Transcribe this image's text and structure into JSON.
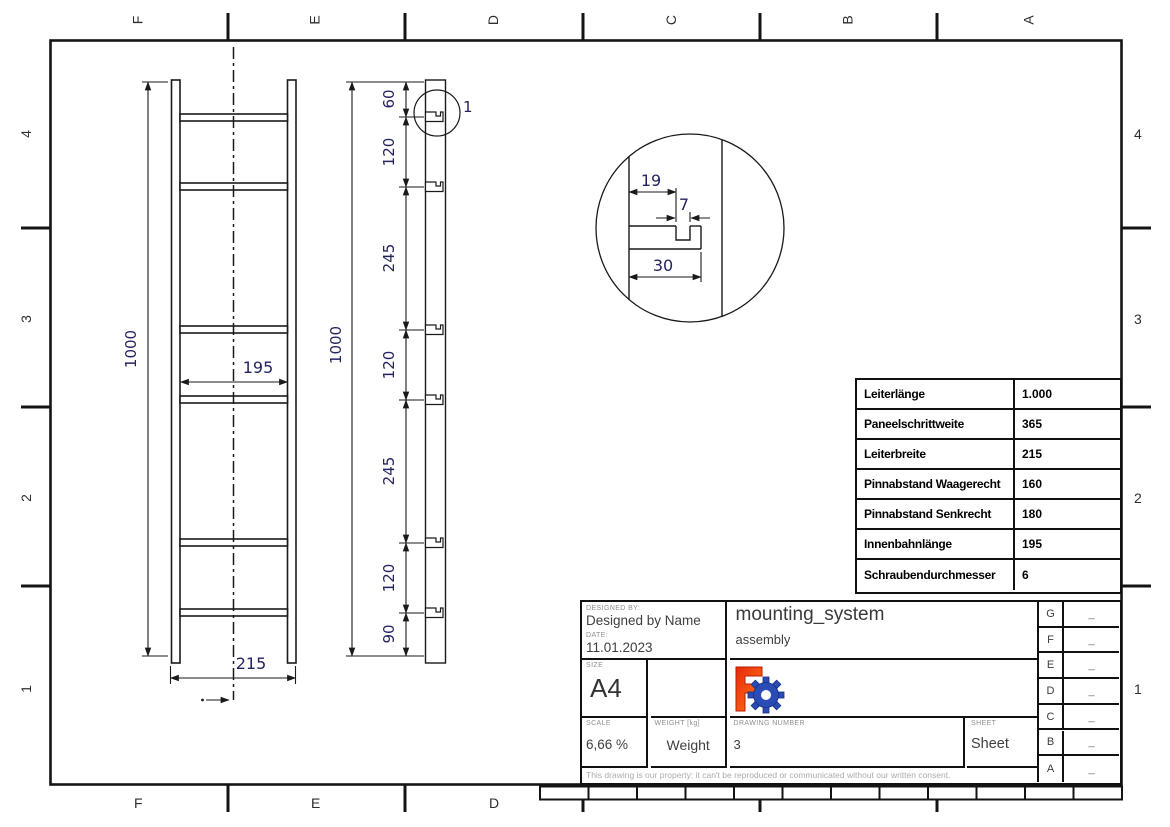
{
  "sheet": {
    "grid_top": [
      "F",
      "E",
      "D",
      "C",
      "B",
      "A"
    ],
    "grid_bottom": [
      "F",
      "E",
      "D"
    ],
    "grid_left": [
      "4",
      "3",
      "2",
      "1"
    ],
    "grid_right": [
      "4",
      "3",
      "2",
      "1"
    ]
  },
  "views": {
    "front": {
      "height": "1000",
      "inner_width": "195",
      "outer_width": "215"
    },
    "side": {
      "height": "1000",
      "chain": [
        "60",
        "120",
        "245",
        "120",
        "245",
        "120",
        "90"
      ],
      "detail_callout": "1"
    },
    "detail": {
      "width_top": "19",
      "notch_width": "7",
      "width_bottom": "30"
    }
  },
  "parameters_table": {
    "rows": [
      {
        "label": "Leiterlänge",
        "value": "1.000"
      },
      {
        "label": "Paneelschrittweite",
        "value": "365"
      },
      {
        "label": "Leiterbreite",
        "value": "215"
      },
      {
        "label": "Pinnabstand Waagerecht",
        "value": "160"
      },
      {
        "label": "Pinnabstand Senkrecht",
        "value": "180"
      },
      {
        "label": "Innenbahnlänge",
        "value": "195"
      },
      {
        "label": "Schraubendurchmesser",
        "value": "6"
      }
    ]
  },
  "title_block": {
    "designed_by_label": "DESIGNED BY:",
    "designed_by": "Designed by Name",
    "date_label": "DATE:",
    "date": "11.01.2023",
    "title": "mounting_system",
    "subtitle": "assembly",
    "size_label": "SIZE",
    "size": "A4",
    "scale_label": "SCALE",
    "scale": "6,66 %",
    "weight_label": "WEIGHT [kg]",
    "weight": "Weight",
    "drawing_number_label": "DRAWING NUMBER",
    "drawing_number": "3",
    "sheet_label": "SHEET",
    "sheet": "Sheet",
    "disclaimer": "This drawing is our property: it can't be reproduced or communicated without our written consent.",
    "revisions": [
      {
        "letter": "G",
        "value": "_"
      },
      {
        "letter": "F",
        "value": "_"
      },
      {
        "letter": "E",
        "value": "_"
      },
      {
        "letter": "D",
        "value": "_"
      },
      {
        "letter": "C",
        "value": "_"
      },
      {
        "letter": "B",
        "value": "_"
      },
      {
        "letter": "A",
        "value": "_"
      }
    ]
  },
  "colors": {
    "line": "#1a1a1a",
    "dimension_text": "#23235f",
    "logo_orange": "#f0440c",
    "logo_blue": "#2b4bb5"
  }
}
